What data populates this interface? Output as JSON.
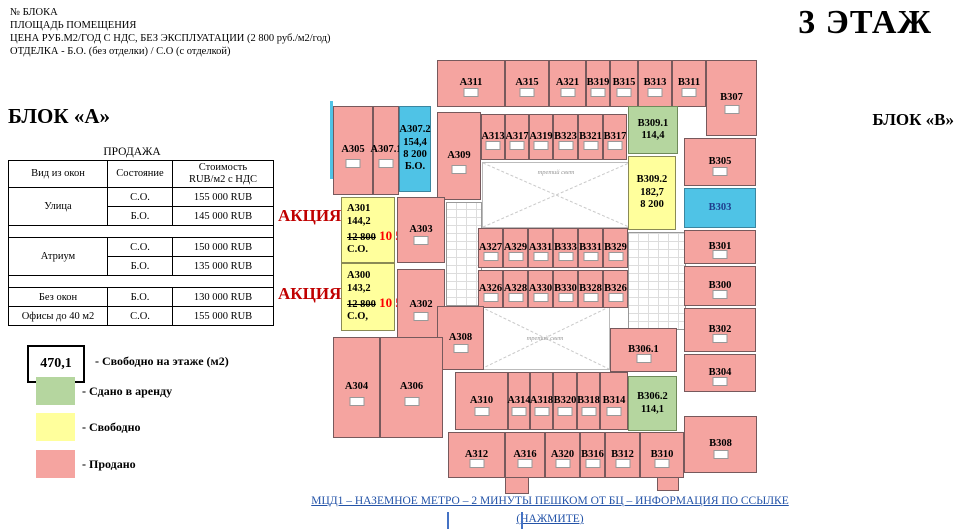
{
  "header": {
    "info_lines": [
      "№ БЛОКА",
      "ПЛОЩАДЬ ПОМЕЩЕНИЯ",
      "ЦЕНА РУБ.М2/ГОД С НДС, БЕЗ ЭКСПЛУАТАЦИИ (2 800 руб./м2/год)",
      "ОТДЕЛКА - Б.О. (без отделки) / С.О (с отделкой)"
    ],
    "floor_title": "3 ЭТАЖ",
    "block_a_label": "БЛОК «А»",
    "block_b_label": "БЛОК «В»"
  },
  "sales_table": {
    "title": "ПРОДАЖА",
    "columns": [
      "Вид из окон",
      "Состояние",
      "Стоимость\nRUB/м2 с НДС"
    ],
    "rows": [
      {
        "view": "Улица",
        "cells": [
          [
            "С.О.",
            "155 000 RUB"
          ],
          [
            "Б.О.",
            "145 000 RUB"
          ]
        ]
      },
      {
        "view": "Атриум",
        "cells": [
          [
            "С.О.",
            "150 000 RUB"
          ],
          [
            "Б.О.",
            "135 000 RUB"
          ]
        ]
      },
      {
        "view": "Без окон",
        "cells": [
          [
            "Б.О.",
            "130 000 RUB"
          ]
        ]
      },
      {
        "view": "Офисы до 40 м2",
        "cells": [
          [
            "С.О.",
            "155 000 RUB"
          ]
        ]
      }
    ]
  },
  "legend": {
    "free_area_value": "470,1",
    "free_area_label": "- Свободно на этаже (м2)",
    "items": [
      {
        "status": "rented",
        "color": "#B5D69F",
        "label": "- Сдано в аренду"
      },
      {
        "status": "free",
        "color": "#FFFF9C",
        "label": "- Свободно"
      },
      {
        "status": "sold",
        "color": "#F5A4A0",
        "label": "- Продано"
      }
    ]
  },
  "promo": {
    "label": "АКЦИЯ!"
  },
  "footer": {
    "link_text": "МЦД1 – НАЗЕМНОЕ МЕТРО – 2 МИНУТЫ ПЕШКОМ ОТ БЦ – ИНФОРМАЦИЯ ПО ССЫЛКЕ (НАЖМИТЕ)"
  },
  "colors": {
    "sold": "#F5A4A0",
    "free": "#FFFF9C",
    "rented": "#B5D69F",
    "special": "#4FC3E6",
    "promo_red": "#C00000",
    "price_red": "#FF0000",
    "link_blue": "#2353A8"
  },
  "floor_plan": {
    "atrium_label": "третий свет",
    "rooms": [
      {
        "id": "А311",
        "x": 437,
        "y": 60,
        "w": 68,
        "h": 47,
        "status": "sold"
      },
      {
        "id": "А315",
        "x": 505,
        "y": 60,
        "w": 44,
        "h": 47,
        "status": "sold"
      },
      {
        "id": "А321",
        "x": 549,
        "y": 60,
        "w": 37,
        "h": 47,
        "status": "sold"
      },
      {
        "id": "В319",
        "x": 586,
        "y": 60,
        "w": 24,
        "h": 47,
        "status": "sold"
      },
      {
        "id": "В315",
        "x": 610,
        "y": 60,
        "w": 28,
        "h": 47,
        "status": "sold"
      },
      {
        "id": "В313",
        "x": 638,
        "y": 60,
        "w": 34,
        "h": 47,
        "status": "sold"
      },
      {
        "id": "В311",
        "x": 672,
        "y": 60,
        "w": 34,
        "h": 47,
        "status": "sold"
      },
      {
        "id": "В307",
        "x": 706,
        "y": 60,
        "w": 51,
        "h": 76,
        "status": "sold"
      },
      {
        "id": "А305",
        "x": 333,
        "y": 106,
        "w": 40,
        "h": 89,
        "status": "sold"
      },
      {
        "id": "А307.1",
        "x": 373,
        "y": 106,
        "w": 26,
        "h": 89,
        "status": "sold"
      },
      {
        "id": "А307.2",
        "x": 399,
        "y": 106,
        "w": 32,
        "h": 86,
        "status": "special",
        "lines": [
          "А307.2",
          "154,4",
          "8 200",
          "Б.О."
        ]
      },
      {
        "id": "А309",
        "x": 437,
        "y": 112,
        "w": 44,
        "h": 88,
        "status": "sold"
      },
      {
        "id": "А313",
        "x": 481,
        "y": 114,
        "w": 24,
        "h": 46,
        "status": "sold"
      },
      {
        "id": "А317",
        "x": 505,
        "y": 114,
        "w": 24,
        "h": 46,
        "status": "sold"
      },
      {
        "id": "А319",
        "x": 529,
        "y": 114,
        "w": 24,
        "h": 46,
        "status": "sold"
      },
      {
        "id": "В323",
        "x": 553,
        "y": 114,
        "w": 25,
        "h": 46,
        "status": "sold"
      },
      {
        "id": "В321",
        "x": 578,
        "y": 114,
        "w": 25,
        "h": 46,
        "status": "sold"
      },
      {
        "id": "В317",
        "x": 603,
        "y": 114,
        "w": 24,
        "h": 46,
        "status": "sold"
      },
      {
        "id": "В309.1",
        "x": 628,
        "y": 106,
        "w": 50,
        "h": 48,
        "status": "rented",
        "lines": [
          "В309.1",
          "114,4"
        ]
      },
      {
        "id": "В309.2",
        "x": 628,
        "y": 156,
        "w": 48,
        "h": 74,
        "status": "free",
        "lines": [
          "В309.2",
          "182,7",
          "8 200"
        ]
      },
      {
        "id": "В305",
        "x": 684,
        "y": 138,
        "w": 72,
        "h": 48,
        "status": "sold"
      },
      {
        "id": "В303",
        "x": 684,
        "y": 188,
        "w": 72,
        "h": 40,
        "status": "special",
        "text_color": "#1F3D8C"
      },
      {
        "id": "В301",
        "x": 684,
        "y": 230,
        "w": 72,
        "h": 34,
        "status": "sold"
      },
      {
        "id": "В300",
        "x": 684,
        "y": 266,
        "w": 72,
        "h": 40,
        "status": "sold"
      },
      {
        "id": "В302",
        "x": 684,
        "y": 308,
        "w": 72,
        "h": 44,
        "status": "sold"
      },
      {
        "id": "В304",
        "x": 684,
        "y": 354,
        "w": 72,
        "h": 38,
        "status": "sold"
      },
      {
        "id": "В308",
        "x": 684,
        "y": 416,
        "w": 73,
        "h": 57,
        "status": "sold"
      },
      {
        "id": "А301",
        "x": 341,
        "y": 197,
        "w": 54,
        "h": 66,
        "status": "free",
        "lines": [
          "А301",
          "144,2"
        ],
        "promo": {
          "old_price": "12 800",
          "new_price": "10 500",
          "condition": "С.О."
        }
      },
      {
        "id": "А303",
        "x": 397,
        "y": 197,
        "w": 48,
        "h": 66,
        "status": "sold"
      },
      {
        "id": "А300",
        "x": 341,
        "y": 263,
        "w": 54,
        "h": 68,
        "status": "free",
        "lines": [
          "А300",
          "143,2"
        ],
        "promo": {
          "old_price": "12 800",
          "new_price": "10 500",
          "condition": "С.О,"
        }
      },
      {
        "id": "А302",
        "x": 397,
        "y": 269,
        "w": 48,
        "h": 72,
        "status": "sold"
      },
      {
        "id": "А327",
        "x": 478,
        "y": 228,
        "w": 25,
        "h": 40,
        "status": "sold"
      },
      {
        "id": "А329",
        "x": 503,
        "y": 228,
        "w": 25,
        "h": 40,
        "status": "sold"
      },
      {
        "id": "А331",
        "x": 528,
        "y": 228,
        "w": 25,
        "h": 40,
        "status": "sold"
      },
      {
        "id": "В333",
        "x": 553,
        "y": 228,
        "w": 25,
        "h": 40,
        "status": "sold"
      },
      {
        "id": "В331",
        "x": 578,
        "y": 228,
        "w": 25,
        "h": 40,
        "status": "sold"
      },
      {
        "id": "В329",
        "x": 603,
        "y": 228,
        "w": 25,
        "h": 40,
        "status": "sold"
      },
      {
        "id": "А326",
        "x": 478,
        "y": 270,
        "w": 25,
        "h": 38,
        "status": "sold"
      },
      {
        "id": "А328",
        "x": 503,
        "y": 270,
        "w": 25,
        "h": 38,
        "status": "sold"
      },
      {
        "id": "А330",
        "x": 528,
        "y": 270,
        "w": 25,
        "h": 38,
        "status": "sold"
      },
      {
        "id": "В330",
        "x": 553,
        "y": 270,
        "w": 25,
        "h": 38,
        "status": "sold"
      },
      {
        "id": "В328",
        "x": 578,
        "y": 270,
        "w": 25,
        "h": 38,
        "status": "sold"
      },
      {
        "id": "В326",
        "x": 603,
        "y": 270,
        "w": 25,
        "h": 38,
        "status": "sold"
      },
      {
        "id": "А308",
        "x": 437,
        "y": 306,
        "w": 47,
        "h": 64,
        "status": "sold"
      },
      {
        "id": "А304",
        "x": 333,
        "y": 337,
        "w": 47,
        "h": 101,
        "status": "sold"
      },
      {
        "id": "А306",
        "x": 380,
        "y": 337,
        "w": 63,
        "h": 101,
        "status": "sold"
      },
      {
        "id": "В306.1",
        "x": 610,
        "y": 328,
        "w": 67,
        "h": 44,
        "status": "sold"
      },
      {
        "id": "В306.2",
        "x": 628,
        "y": 376,
        "w": 49,
        "h": 55,
        "status": "rented",
        "lines": [
          "В306.2",
          "114,1"
        ]
      },
      {
        "id": "А310",
        "x": 455,
        "y": 372,
        "w": 53,
        "h": 58,
        "status": "sold"
      },
      {
        "id": "А314",
        "x": 508,
        "y": 372,
        "w": 22,
        "h": 58,
        "status": "sold"
      },
      {
        "id": "А318",
        "x": 530,
        "y": 372,
        "w": 23,
        "h": 58,
        "status": "sold"
      },
      {
        "id": "В320",
        "x": 553,
        "y": 372,
        "w": 24,
        "h": 58,
        "status": "sold"
      },
      {
        "id": "В318",
        "x": 577,
        "y": 372,
        "w": 23,
        "h": 58,
        "status": "sold"
      },
      {
        "id": "В314",
        "x": 600,
        "y": 372,
        "w": 28,
        "h": 58,
        "status": "sold"
      },
      {
        "id": "А312",
        "x": 448,
        "y": 432,
        "w": 57,
        "h": 46,
        "status": "sold"
      },
      {
        "id": "А316",
        "x": 505,
        "y": 432,
        "w": 40,
        "h": 46,
        "status": "sold"
      },
      {
        "id": "А320",
        "x": 545,
        "y": 432,
        "w": 35,
        "h": 46,
        "status": "sold"
      },
      {
        "id": "В316",
        "x": 580,
        "y": 432,
        "w": 25,
        "h": 46,
        "status": "sold"
      },
      {
        "id": "В312",
        "x": 605,
        "y": 432,
        "w": 35,
        "h": 46,
        "status": "sold"
      },
      {
        "id": "В310",
        "x": 640,
        "y": 432,
        "w": 44,
        "h": 46,
        "status": "sold"
      }
    ]
  }
}
